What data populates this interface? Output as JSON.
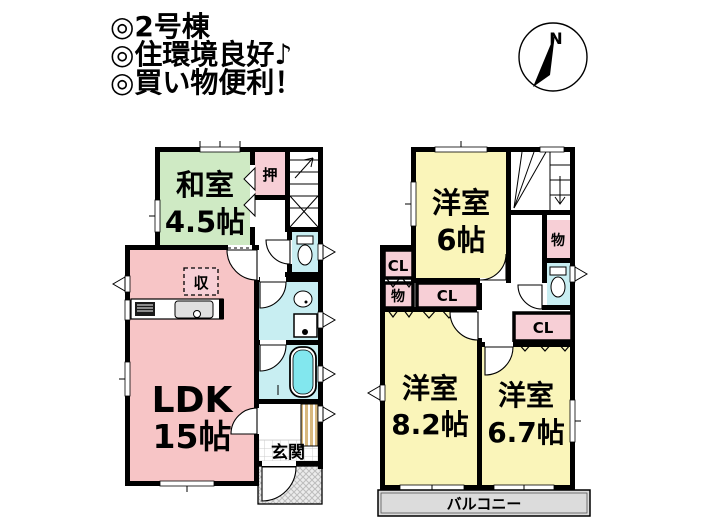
{
  "header": {
    "lines": [
      "◎2号棟",
      "◎住環境良好♪",
      "◎買い物便利！"
    ]
  },
  "compass": {
    "north": "N"
  },
  "floor1": {
    "washitsu": {
      "name": "和室",
      "size": "4.5帖"
    },
    "ldk": {
      "name": "LDK",
      "size": "15帖"
    },
    "oshiire": "押",
    "shuno": "収",
    "genkan": "玄関"
  },
  "floor2": {
    "room6": {
      "name": "洋室",
      "size": "6帖"
    },
    "room82": {
      "name": "洋室",
      "size": "8.2帖"
    },
    "room67": {
      "name": "洋室",
      "size": "6.7帖"
    },
    "closet": "CL",
    "storage": "物",
    "balcony": "バルコニー"
  },
  "colors": {
    "wall": "#000000",
    "tatami_green": "#cfeac4",
    "ldk_pink": "#f7c5c6",
    "closet_pink": "#f7cfd6",
    "room_yellow": "#faf5ba",
    "water_cyan": "#c8eef2",
    "tub_cyan": "#82e7ee",
    "balcony_gray": "#dcdcdc",
    "cabinet_tan": "#d8b87e"
  }
}
